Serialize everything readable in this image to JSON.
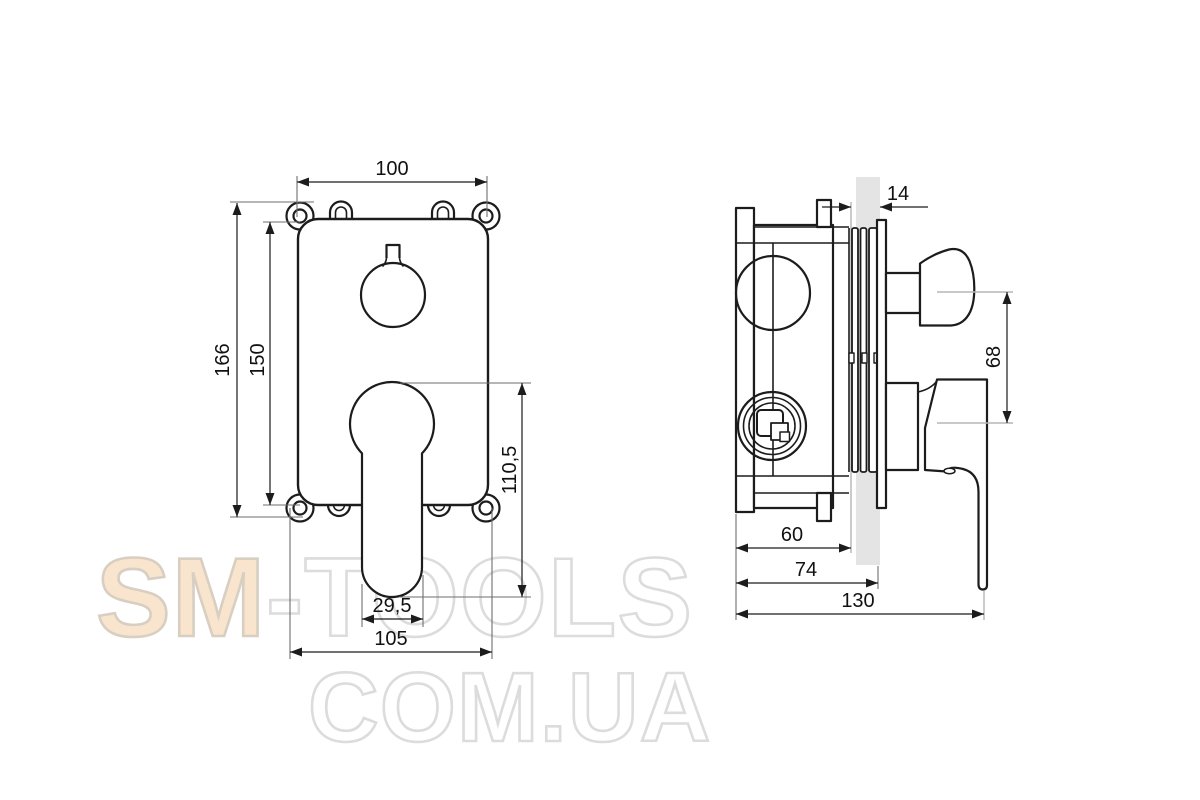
{
  "watermark": {
    "brand_filled": "SM",
    "brand_outline": "-TOOLS",
    "domain_line": "COM.UA",
    "fill_color": "#f9e4cd",
    "outline_color": "#dcdcdc"
  },
  "drawing": {
    "line_color": "#1c1c1c",
    "wall_fill": "#e4e4e4",
    "front_view": {
      "dims": {
        "width_top": "100",
        "height_outer": "166",
        "height_plate": "150",
        "handle_drop": "110,5",
        "handle_width": "29,5",
        "width_bottom": "105"
      }
    },
    "side_view": {
      "dims": {
        "wall_thickness": "14",
        "axis_spacing": "68",
        "depth_body": "60",
        "depth_to_wall": "74",
        "depth_total": "130"
      }
    }
  }
}
